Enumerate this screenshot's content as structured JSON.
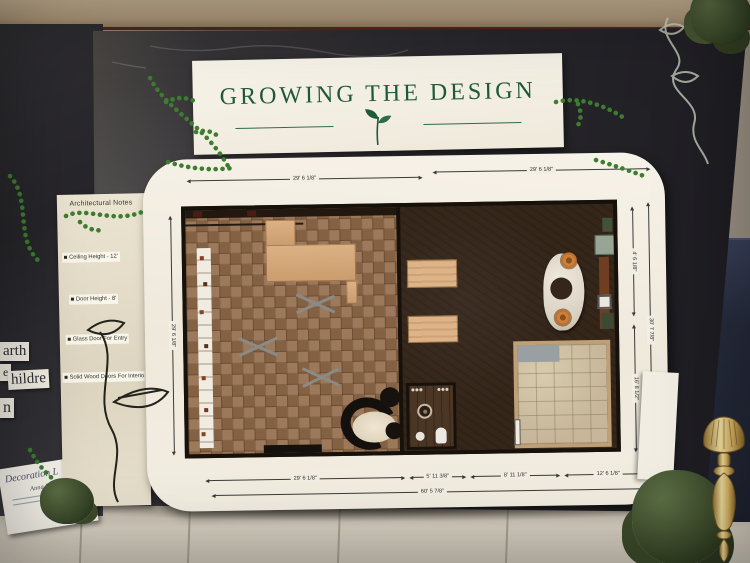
{
  "title_card": {
    "title": "GROWING THE DESIGN"
  },
  "notes": {
    "heading": "Architectural Notes",
    "items": [
      "Ceiling Height - 12'",
      "Door Height - 8'",
      "Glass Door For Entry",
      "Solid Wood Doors For Interior"
    ]
  },
  "dimensions": {
    "top_left": "29' 6 1/8\"",
    "top_right": "29' 6 1/8\"",
    "left_side": "29' 6 1/8\"",
    "right_upper": "4' 6 1/8\"",
    "right_full": "30' 7 7/8\"",
    "right_lower": "16' 8 1/2\"",
    "bottom_seg1": "29' 6 1/8\"",
    "bottom_seg2": "5' 11 3/8\"",
    "bottom_seg3": "8' 11 1/8\"",
    "bottom_seg4": "12' 6 1/8\"",
    "bottom_total": "60' 5 7/8\""
  },
  "background_board": {
    "fragment1": "arth",
    "fragment2": "e",
    "fragment3": "hildre",
    "fragment4": "n",
    "card_line1": "Decoration L",
    "card_line2": "Anna Rainey"
  }
}
